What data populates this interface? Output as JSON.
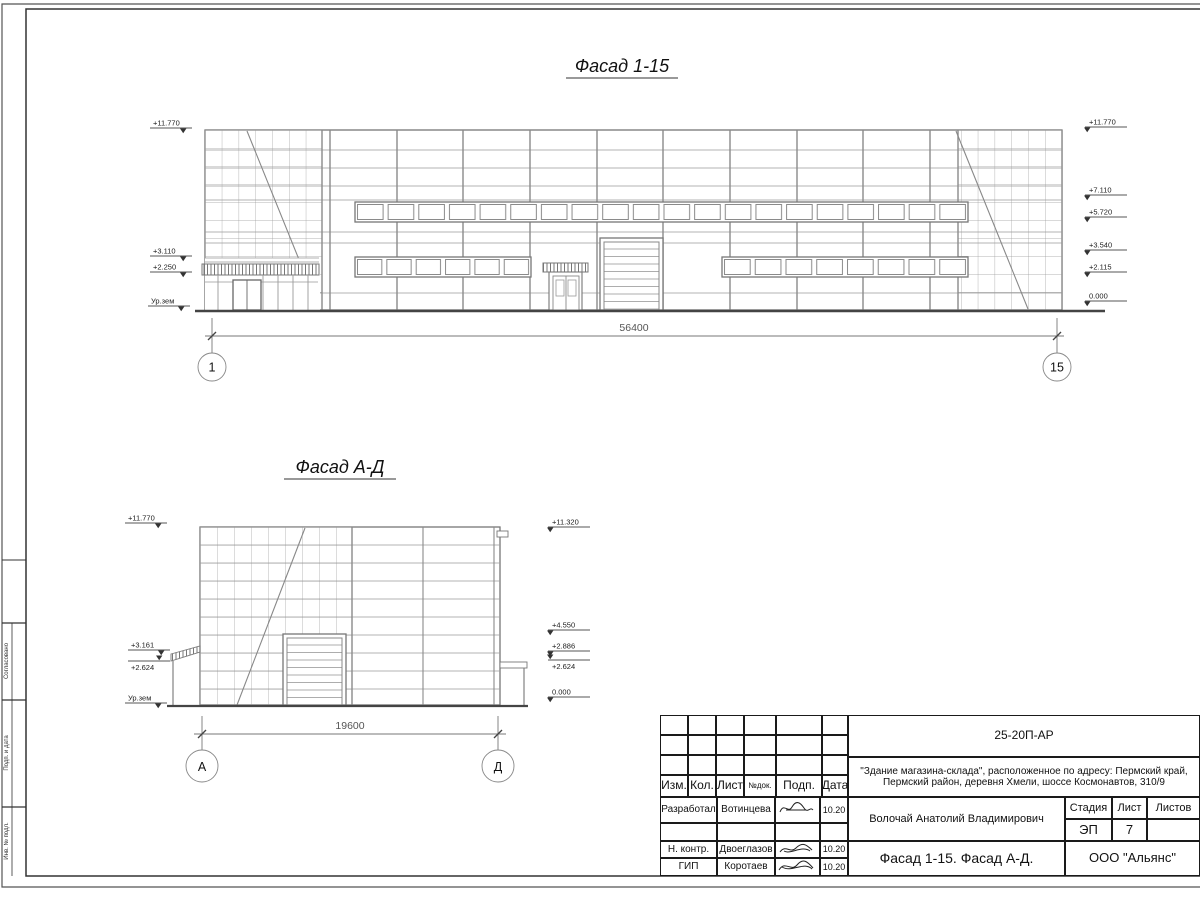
{
  "colors": {
    "drawing_line": "#808080",
    "dark_line": "#444444",
    "text": "#1a1a1a"
  },
  "facade1": {
    "title": "Фасад 1-15",
    "dim": "56400",
    "axis_left": "1",
    "axis_right": "15",
    "marks_left": [
      "+11.770",
      "+3.110",
      "+2.250",
      "Ур.зем"
    ],
    "marks_right": [
      "+11.770",
      "+7.110",
      "+5.720",
      "+3.540",
      "+2.115",
      "0.000"
    ]
  },
  "facade2": {
    "title": "Фасад А-Д",
    "dim": "19600",
    "axis_left": "А",
    "axis_right": "Д",
    "marks_left": [
      "+11.770",
      "+3.161",
      "+2.624",
      "Ур.зем"
    ],
    "marks_right": [
      "+11.320",
      "+4.550",
      "+2.886",
      "+2.624",
      "0.000"
    ]
  },
  "titleblock": {
    "doc_number": "25-20П-АР",
    "address_line1": "\"Здание магазина-склада\", расположенное по адресу: Пермский край,",
    "address_line2": "Пермский район, деревня Хмели, шоссе Космонавтов, 310/9",
    "header": {
      "izm": "Изм.",
      "kol": "Кол.",
      "list": "Лист",
      "ndok": "№док.",
      "podp": "Подп.",
      "data": "Дата"
    },
    "rows": [
      {
        "role": "Разработал",
        "name": "Вотинцева",
        "date": "10.20"
      },
      {
        "role": "Н. контр.",
        "name": "Двоеглазов",
        "date": "10.20"
      },
      {
        "role": "ГИП",
        "name": "Коротаев",
        "date": "10.20"
      }
    ],
    "designer_full": "Волочай Анатолий Владимирович",
    "stage_label": "Стадия",
    "sheet_label": "Лист",
    "sheets_label": "Листов",
    "stage": "ЭП",
    "sheet_no": "7",
    "sheet_title": "Фасад 1-15. Фасад А-Д.",
    "company": "ООО \"Альянс\""
  },
  "side_stamp": {
    "labels": [
      "Согласовано",
      "Подп. и дата",
      "Инв. № подл."
    ]
  }
}
